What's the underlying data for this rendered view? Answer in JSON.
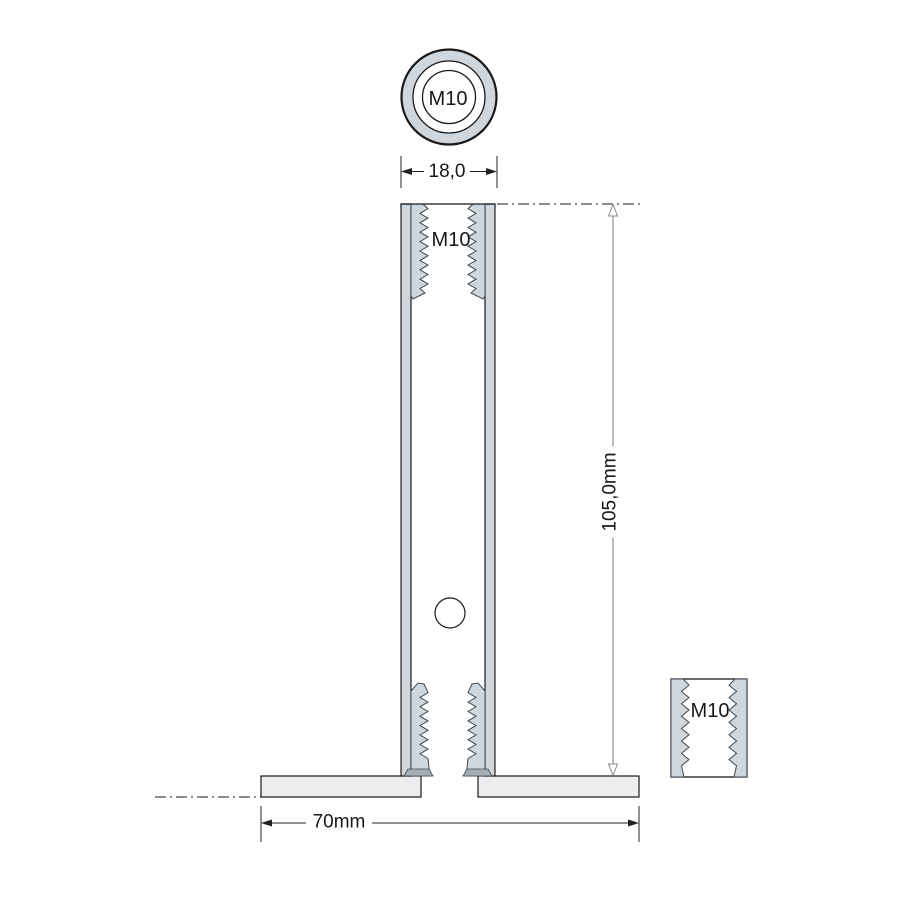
{
  "labels": {
    "top_view_thread": "M10",
    "side_view_thread": "M10",
    "detail_thread": "M10"
  },
  "dimensions": {
    "diameter": "18,0",
    "height": "105,0mm",
    "base_width": "70mm"
  },
  "colors": {
    "material": "#cfd7dd",
    "base": "#ecedee",
    "outline": "#1a1a1a",
    "thread_edge": "#3f4850",
    "dim_gray": "#a0a0a0",
    "foot": "#a3adb4",
    "text": "#15181b"
  }
}
